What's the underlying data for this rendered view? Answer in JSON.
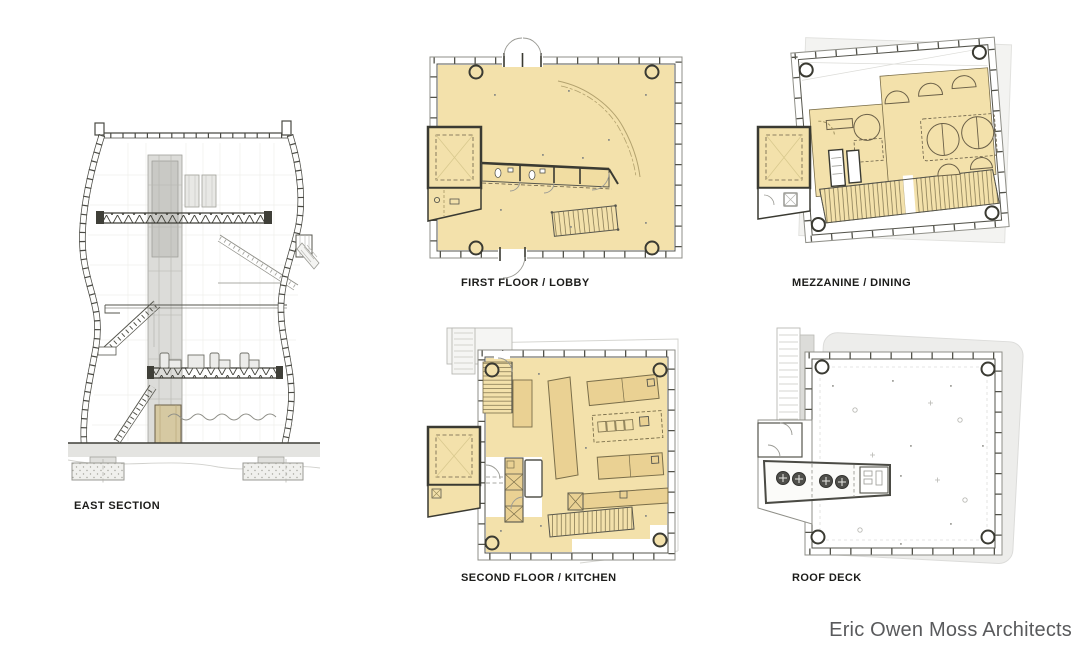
{
  "sheet": {
    "background": "#ffffff",
    "type": "architectural-presentation-sheet"
  },
  "watermark": {
    "text": "Eric Owen Moss Architects",
    "color": "#595a5c"
  },
  "drawings": {
    "east_section": {
      "label": "EAST SECTION",
      "kind": "building-section"
    },
    "first_floor": {
      "label": "FIRST FLOOR / LOBBY",
      "kind": "floor-plan"
    },
    "mezzanine": {
      "label": "MEZZANINE / DINING",
      "kind": "floor-plan"
    },
    "second_floor": {
      "label": "SECOND FLOOR / KITCHEN",
      "kind": "floor-plan"
    },
    "roof_deck": {
      "label": "ROOF DECK",
      "kind": "floor-plan"
    }
  },
  "palette": {
    "floor_fill": "#f3e1ab",
    "equipment_fill": "#ead193",
    "plan_line_dark": "#3f3f38",
    "plan_line_mid": "#8f8f88",
    "section_gray": "#d9d9d6",
    "roof_silhouette": "#ededeb",
    "caption_color": "#1c1c1a"
  }
}
